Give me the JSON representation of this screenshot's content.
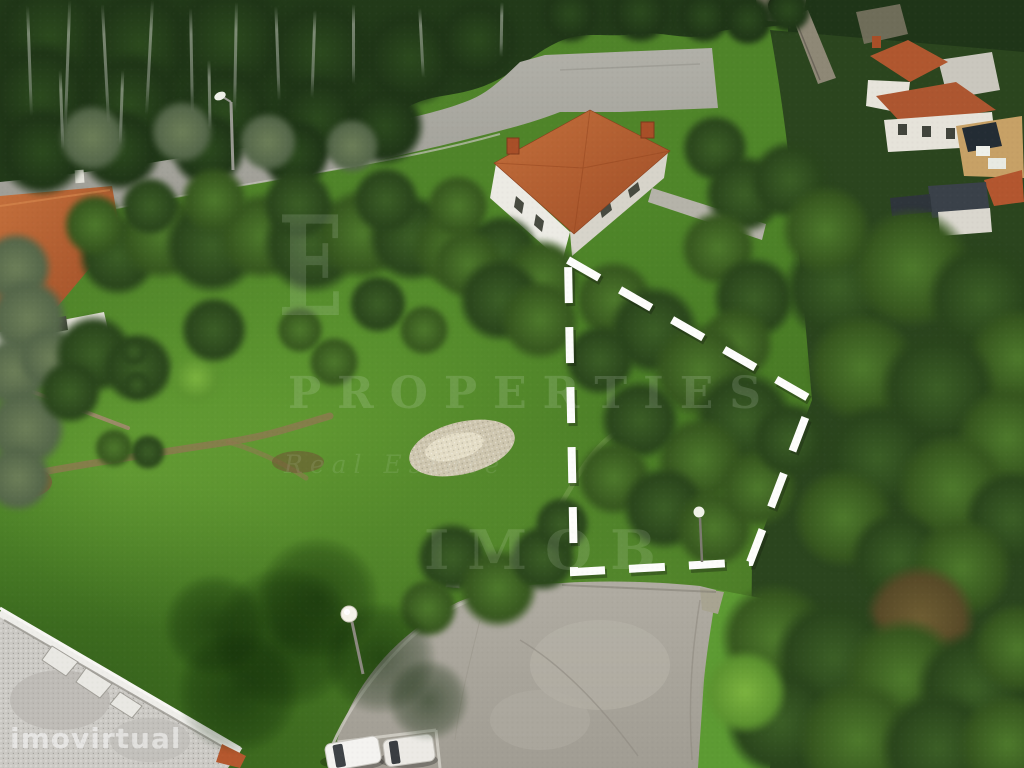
{
  "photo": {
    "kind": "aerial-drone-photo",
    "subject": "building plot for sale outlined with white dashed boundary"
  },
  "watermarks": {
    "monogram": "E",
    "brand_line1": "PROPERTIES",
    "brand_line2": "Real Estate",
    "brand_line3": "IMOB",
    "portal": "imovirtual"
  },
  "plot": {
    "outline_points": "568,260 812,400 750,562 574,572",
    "outline_color": "#fdfdfb"
  },
  "palette": {
    "grass": "#4f8629",
    "forest": "#223a19",
    "road": "#a8a79e",
    "concrete": "#aba79e",
    "roof_terracotta": "#b4592e",
    "wall_white": "#e9e6df",
    "boundary_white": "#fdfdfb"
  },
  "scene": {
    "trees": [
      [
        50,
        36,
        60,
        "f"
      ],
      [
        140,
        44,
        58,
        "f"
      ],
      [
        230,
        40,
        60,
        "f"
      ],
      [
        320,
        52,
        55,
        "f"
      ],
      [
        410,
        58,
        50,
        "f"
      ],
      [
        478,
        40,
        42,
        "f"
      ],
      [
        40,
        96,
        55,
        "f"
      ],
      [
        130,
        104,
        52,
        "f"
      ],
      [
        225,
        112,
        48,
        "f"
      ],
      [
        318,
        118,
        44,
        "f"
      ],
      [
        385,
        126,
        40,
        "f"
      ],
      [
        120,
        150,
        42,
        "f"
      ],
      [
        42,
        152,
        45,
        "f"
      ],
      [
        208,
        150,
        38,
        "f"
      ],
      [
        295,
        154,
        36,
        "f"
      ],
      [
        570,
        14,
        30,
        "f"
      ],
      [
        640,
        12,
        32,
        "f"
      ],
      [
        704,
        16,
        28,
        "f"
      ],
      [
        748,
        20,
        26,
        "f"
      ],
      [
        788,
        10,
        24,
        "f"
      ],
      [
        92,
        138,
        34,
        "o"
      ],
      [
        182,
        132,
        32,
        "o"
      ],
      [
        268,
        142,
        30,
        "o"
      ],
      [
        352,
        146,
        28,
        "o"
      ],
      [
        118,
        256,
        40,
        "d"
      ],
      [
        162,
        236,
        44,
        "m"
      ],
      [
        212,
        246,
        48,
        "d"
      ],
      [
        262,
        236,
        44,
        "m"
      ],
      [
        312,
        244,
        50,
        "d"
      ],
      [
        362,
        234,
        46,
        "m"
      ],
      [
        412,
        238,
        44,
        "d"
      ],
      [
        452,
        248,
        40,
        "m"
      ],
      [
        298,
        204,
        36,
        "d"
      ],
      [
        214,
        200,
        34,
        "m"
      ],
      [
        386,
        200,
        34,
        "d"
      ],
      [
        458,
        206,
        32,
        "m"
      ],
      [
        502,
        252,
        38,
        "d"
      ],
      [
        542,
        278,
        40,
        "m"
      ],
      [
        150,
        206,
        30,
        "d"
      ],
      [
        95,
        225,
        32,
        "m"
      ],
      [
        16,
        268,
        36,
        "o"
      ],
      [
        28,
        318,
        40,
        "o"
      ],
      [
        14,
        372,
        36,
        "o"
      ],
      [
        26,
        428,
        40,
        "o"
      ],
      [
        50,
        358,
        32,
        "o"
      ],
      [
        18,
        478,
        34,
        "o"
      ],
      [
        94,
        354,
        40,
        "d"
      ],
      [
        138,
        368,
        36,
        "d"
      ],
      [
        70,
        392,
        32,
        "d"
      ],
      [
        134,
        352,
        14,
        "d"
      ],
      [
        137,
        385,
        14,
        "d"
      ],
      [
        196,
        378,
        26,
        "b"
      ],
      [
        114,
        448,
        20,
        "m"
      ],
      [
        148,
        452,
        18,
        "d"
      ],
      [
        214,
        330,
        34,
        "d"
      ],
      [
        334,
        362,
        26,
        "m"
      ],
      [
        378,
        304,
        30,
        "d"
      ],
      [
        424,
        330,
        26,
        "m"
      ],
      [
        300,
        330,
        24,
        "m"
      ],
      [
        468,
        264,
        36,
        "m"
      ],
      [
        500,
        300,
        42,
        "d"
      ],
      [
        540,
        320,
        40,
        "m"
      ],
      [
        715,
        148,
        34,
        "d"
      ],
      [
        744,
        194,
        40,
        "d"
      ],
      [
        718,
        248,
        38,
        "m"
      ],
      [
        754,
        298,
        42,
        "d"
      ],
      [
        736,
        344,
        38,
        "m"
      ],
      [
        790,
        180,
        40,
        "d"
      ],
      [
        614,
        300,
        40,
        "m"
      ],
      [
        654,
        330,
        45,
        "d"
      ],
      [
        700,
        370,
        48,
        "m"
      ],
      [
        744,
        420,
        50,
        "d"
      ],
      [
        700,
        460,
        44,
        "m"
      ],
      [
        640,
        420,
        40,
        "d"
      ],
      [
        614,
        478,
        38,
        "m"
      ],
      [
        664,
        508,
        42,
        "d"
      ],
      [
        714,
        528,
        40,
        "m"
      ],
      [
        758,
        488,
        40,
        "m"
      ],
      [
        790,
        440,
        38,
        "d"
      ],
      [
        600,
        360,
        36,
        "d"
      ],
      [
        838,
        288,
        55,
        "d"
      ],
      [
        912,
        268,
        60,
        "m"
      ],
      [
        982,
        298,
        55,
        "d"
      ],
      [
        1018,
        358,
        50,
        "m"
      ],
      [
        862,
        368,
        55,
        "m"
      ],
      [
        938,
        388,
        58,
        "d"
      ],
      [
        1008,
        438,
        52,
        "m"
      ],
      [
        878,
        458,
        55,
        "d"
      ],
      [
        952,
        488,
        55,
        "m"
      ],
      [
        1012,
        518,
        48,
        "d"
      ],
      [
        843,
        518,
        50,
        "m"
      ],
      [
        898,
        558,
        48,
        "d"
      ],
      [
        962,
        568,
        50,
        "m"
      ],
      [
        826,
        230,
        45,
        "m"
      ],
      [
        920,
        620,
        55,
        "r"
      ],
      [
        876,
        690,
        50,
        "r"
      ],
      [
        775,
        638,
        55,
        "m"
      ],
      [
        834,
        658,
        60,
        "d"
      ],
      [
        904,
        678,
        60,
        "m"
      ],
      [
        974,
        688,
        58,
        "d"
      ],
      [
        1018,
        648,
        45,
        "m"
      ],
      [
        780,
        722,
        55,
        "d"
      ],
      [
        858,
        740,
        60,
        "m"
      ],
      [
        938,
        748,
        58,
        "d"
      ],
      [
        1008,
        744,
        50,
        "m"
      ],
      [
        745,
        692,
        42,
        "b"
      ],
      [
        452,
        558,
        36,
        "d"
      ],
      [
        498,
        588,
        40,
        "m"
      ],
      [
        543,
        558,
        34,
        "d"
      ],
      [
        428,
        608,
        30,
        "m"
      ],
      [
        562,
        524,
        28,
        "d"
      ],
      [
        285,
        638,
        70,
        "s"
      ],
      [
        238,
        692,
        60,
        "s"
      ],
      [
        318,
        598,
        60,
        "s"
      ],
      [
        380,
        658,
        55,
        "s"
      ],
      [
        428,
        700,
        40,
        "s"
      ],
      [
        215,
        625,
        50,
        "s"
      ]
    ],
    "trunks": [
      [
        28,
        6,
        110,
        88
      ],
      [
        66,
        0,
        130,
        92
      ],
      [
        104,
        4,
        120,
        87
      ],
      [
        148,
        0,
        115,
        93
      ],
      [
        190,
        8,
        105,
        89
      ],
      [
        234,
        2,
        110,
        91
      ],
      [
        276,
        6,
        95,
        88
      ],
      [
        312,
        10,
        88,
        92
      ],
      [
        352,
        4,
        80,
        90
      ],
      [
        420,
        8,
        70,
        87
      ],
      [
        500,
        2,
        55,
        91
      ],
      [
        208,
        60,
        70,
        89
      ],
      [
        120,
        70,
        75,
        92
      ],
      [
        60,
        70,
        80,
        88
      ]
    ]
  }
}
